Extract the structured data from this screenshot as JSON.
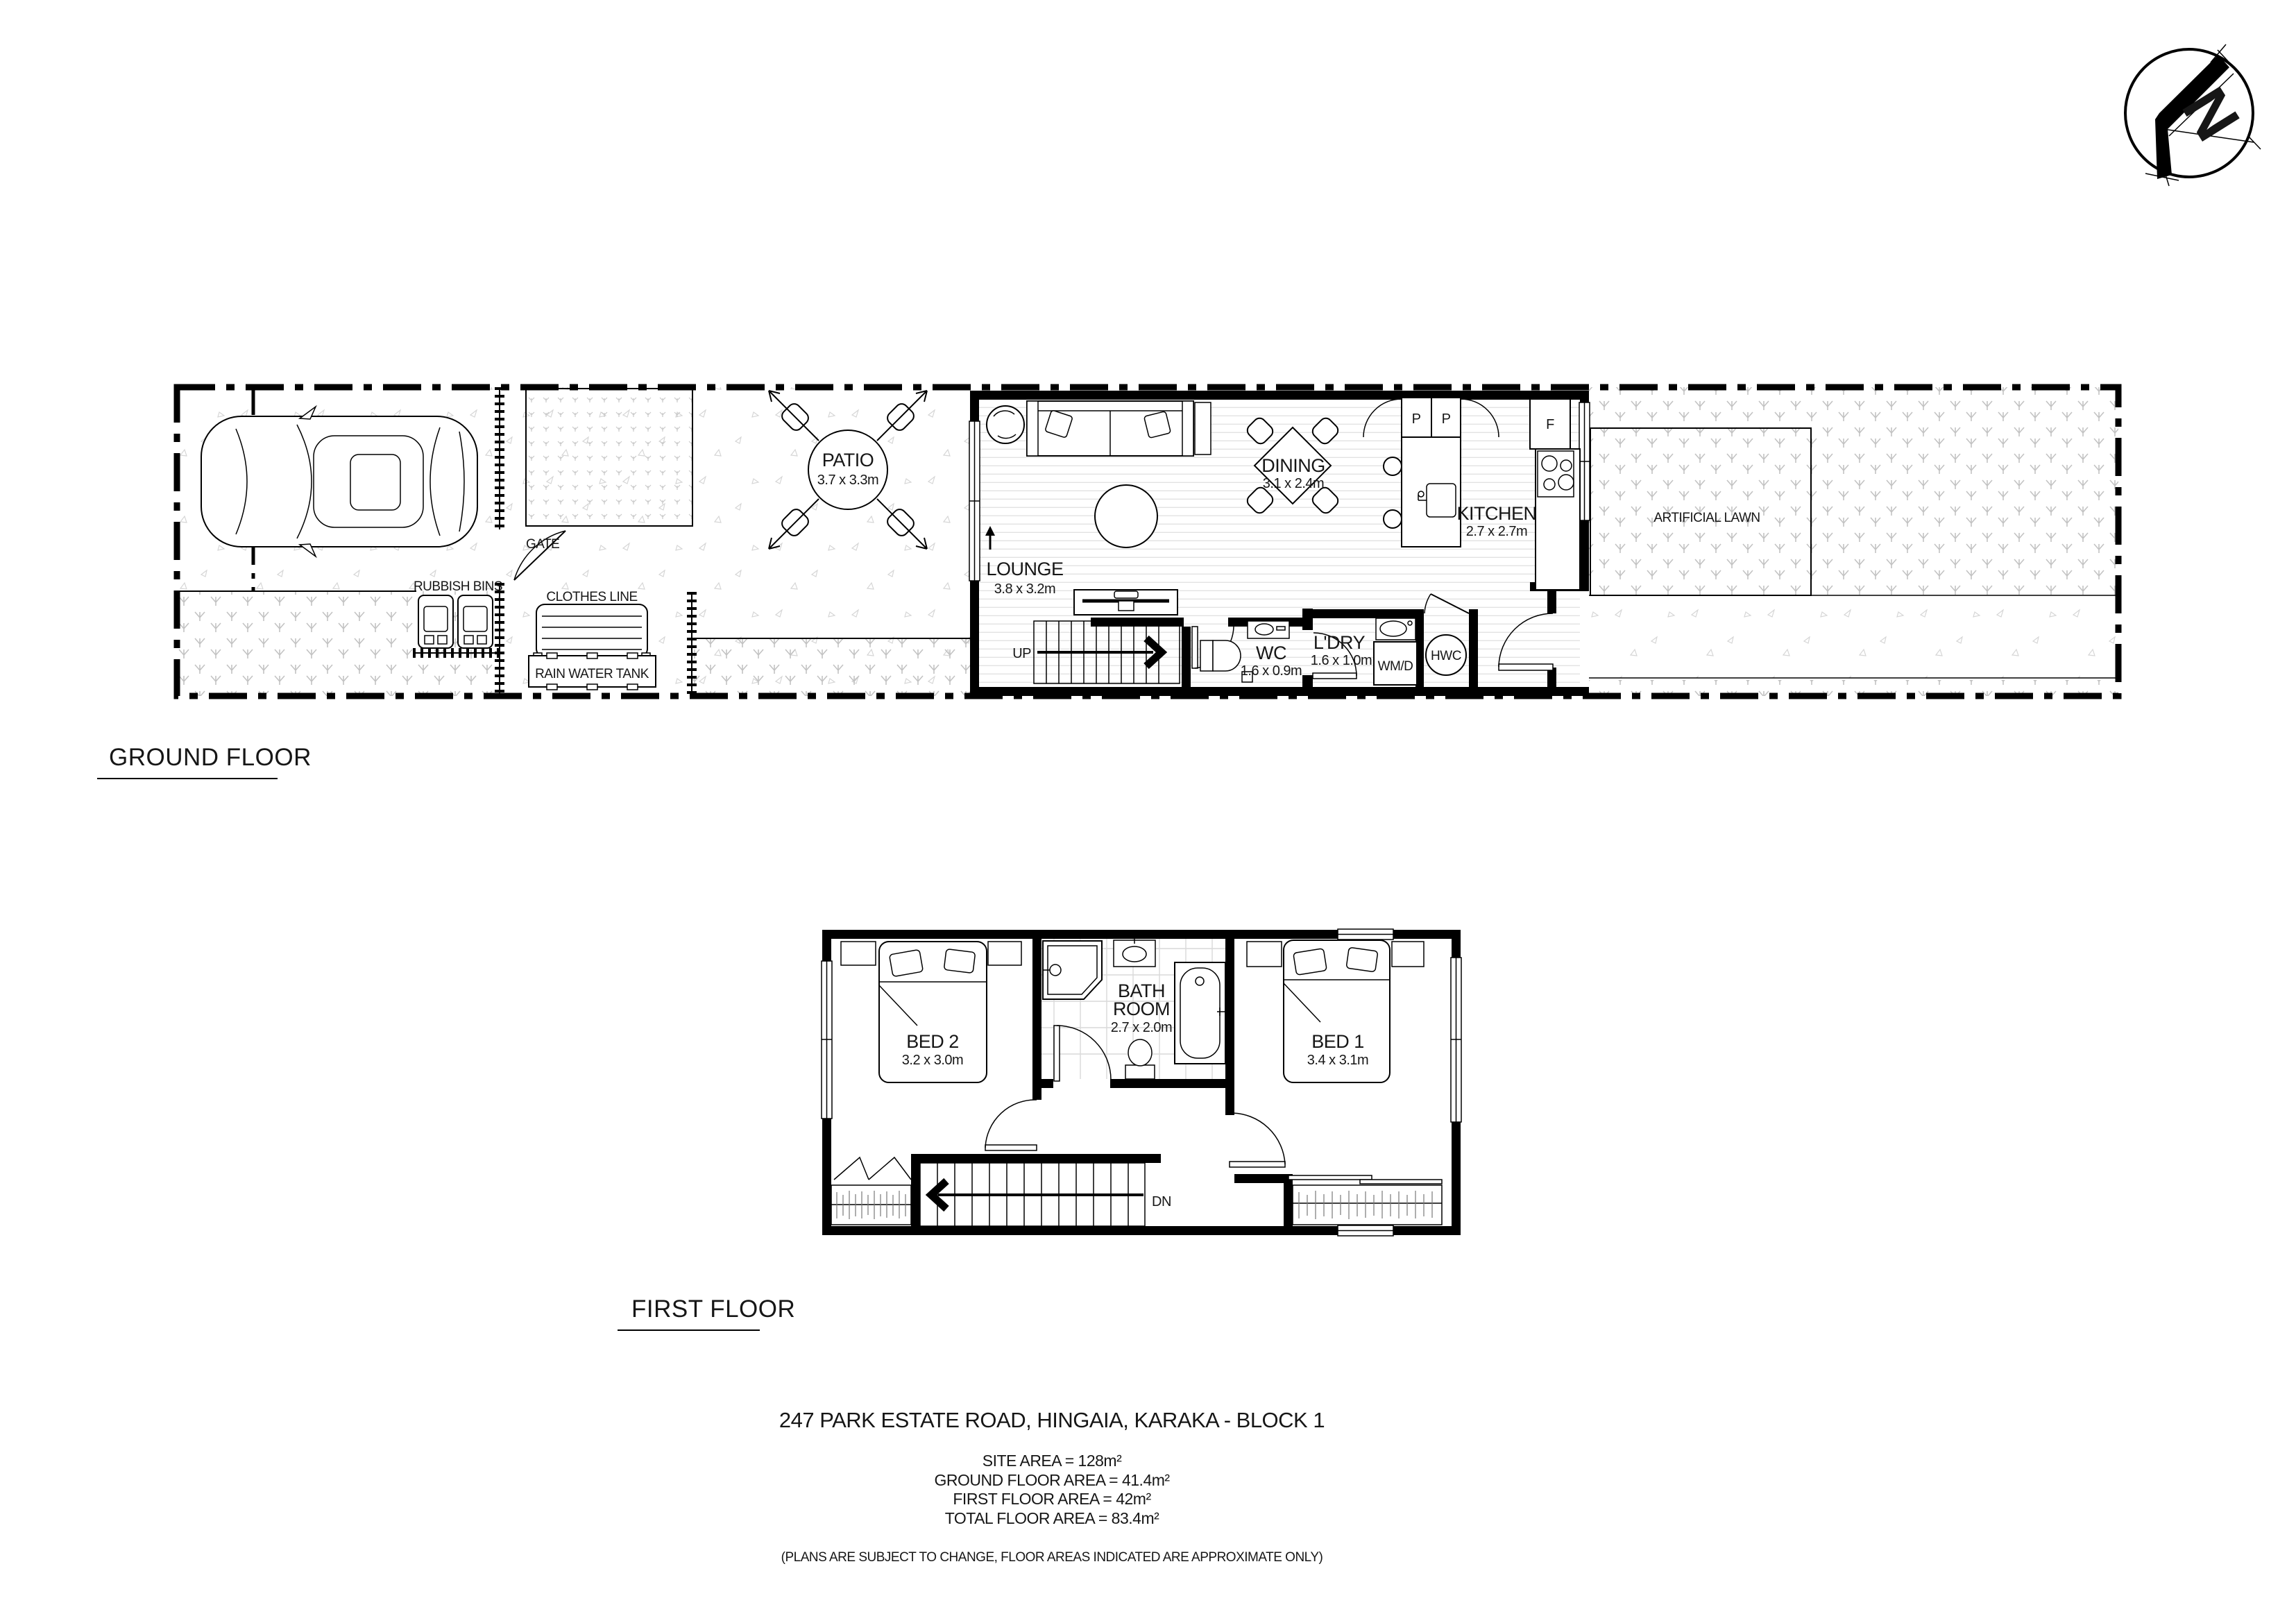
{
  "north_arrow": {
    "label": "N"
  },
  "ground_floor": {
    "section_label": "GROUND FLOOR",
    "site_labels": {
      "gate": "GATE",
      "rubbish_bins": "RUBBISH BINS",
      "clothes_line": "CLOTHES LINE",
      "rain_water_tank": "RAIN WATER TANK",
      "artificial_lawn": "ARTIFICIAL LAWN"
    },
    "rooms": {
      "patio": {
        "name": "PATIO",
        "dims": "3.7 x 3.3m"
      },
      "lounge": {
        "name": "LOUNGE",
        "dims": "3.8 x 3.2m"
      },
      "dining": {
        "name": "DINING",
        "dims": "3.1 x 2.4m"
      },
      "kitchen": {
        "name": "KITCHEN",
        "dims": "2.7 x 2.7m"
      },
      "wc": {
        "name": "WC",
        "dims": "1.6 x 0.9m"
      },
      "ldry": {
        "name": "L'DRY",
        "dims": "1.6 x 1.0m"
      }
    },
    "annotations": {
      "up": "UP",
      "pantry_left": "P",
      "pantry_right": "P",
      "fridge": "F",
      "washer_dryer": "WM/D",
      "hot_water_cylinder": "HWC"
    }
  },
  "first_floor": {
    "section_label": "FIRST FLOOR",
    "rooms": {
      "bed2": {
        "name": "BED 2",
        "dims": "3.2 x 3.0m"
      },
      "bed1": {
        "name": "BED 1",
        "dims": "3.4 x 3.1m"
      },
      "bathroom": {
        "line1": "BATH",
        "line2": "ROOM",
        "dims": "2.7 x 2.0m"
      }
    },
    "annotations": {
      "dn": "DN"
    }
  },
  "title_block": {
    "address": "247 PARK ESTATE ROAD, HINGAIA, KARAKA - BLOCK 1",
    "site_area": "SITE AREA = 128m²",
    "ground_floor_area": "GROUND FLOOR AREA = 41.4m²",
    "first_floor_area": "FIRST FLOOR AREA = 42m²",
    "total_floor_area": "TOTAL FLOOR AREA = 83.4m²",
    "disclaimer": "(PLANS ARE SUBJECT TO CHANGE, FLOOR AREAS INDICATED ARE APPROXIMATE ONLY)"
  },
  "colors": {
    "ink": "#000000",
    "floorboard": "#e2e2e2",
    "texture": "#c6c6c6"
  }
}
